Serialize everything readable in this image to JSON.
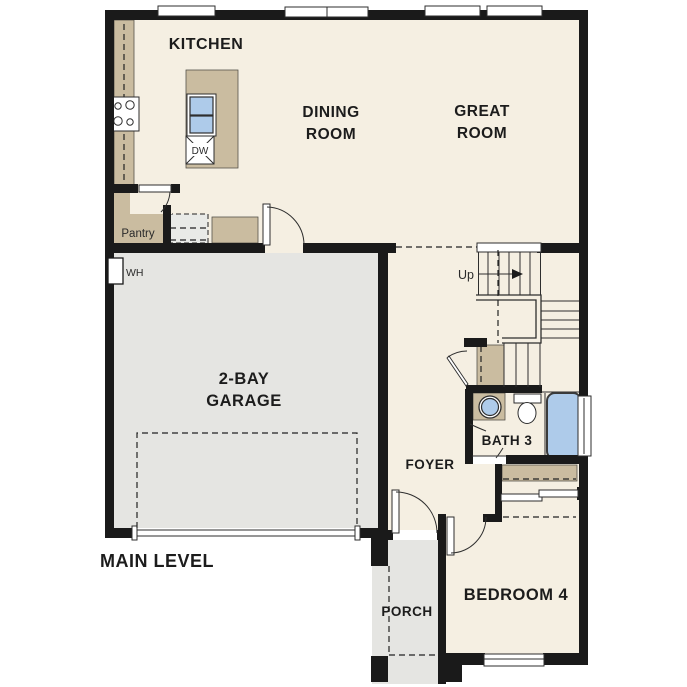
{
  "floorplan": {
    "level_label": "MAIN LEVEL",
    "rooms": {
      "kitchen": "KITCHEN",
      "dining_line1": "DINING",
      "dining_line2": "ROOM",
      "great_line1": "GREAT",
      "great_line2": "ROOM",
      "garage_line1": "2-BAY",
      "garage_line2": "GARAGE",
      "pantry": "Pantry",
      "foyer": "FOYER",
      "bath3": "BATH 3",
      "porch": "PORCH",
      "bedroom4": "BEDROOM 4"
    },
    "annotations": {
      "stairs_direction": "Up",
      "water_heater": "WH",
      "dishwasher": "DW"
    },
    "colors": {
      "wall": "#1a1a1a",
      "floor": "#f5efe2",
      "garage_floor": "#e5e5e2",
      "cabinet_tan": "#cabca0",
      "fixture_blue": "#aecbea",
      "exterior": "#ffffff"
    },
    "fixtures": [
      "cooktop-icon",
      "island-sink-icon",
      "dishwasher-icon",
      "refrigerator-icon",
      "water-heater-icon",
      "stairs-icon",
      "bath-sink-icon",
      "toilet-icon",
      "bathtub-icon",
      "closet-shelf-icon",
      "sliding-door-icon",
      "garage-door-icon",
      "window-icon",
      "door-swing-icon"
    ]
  }
}
